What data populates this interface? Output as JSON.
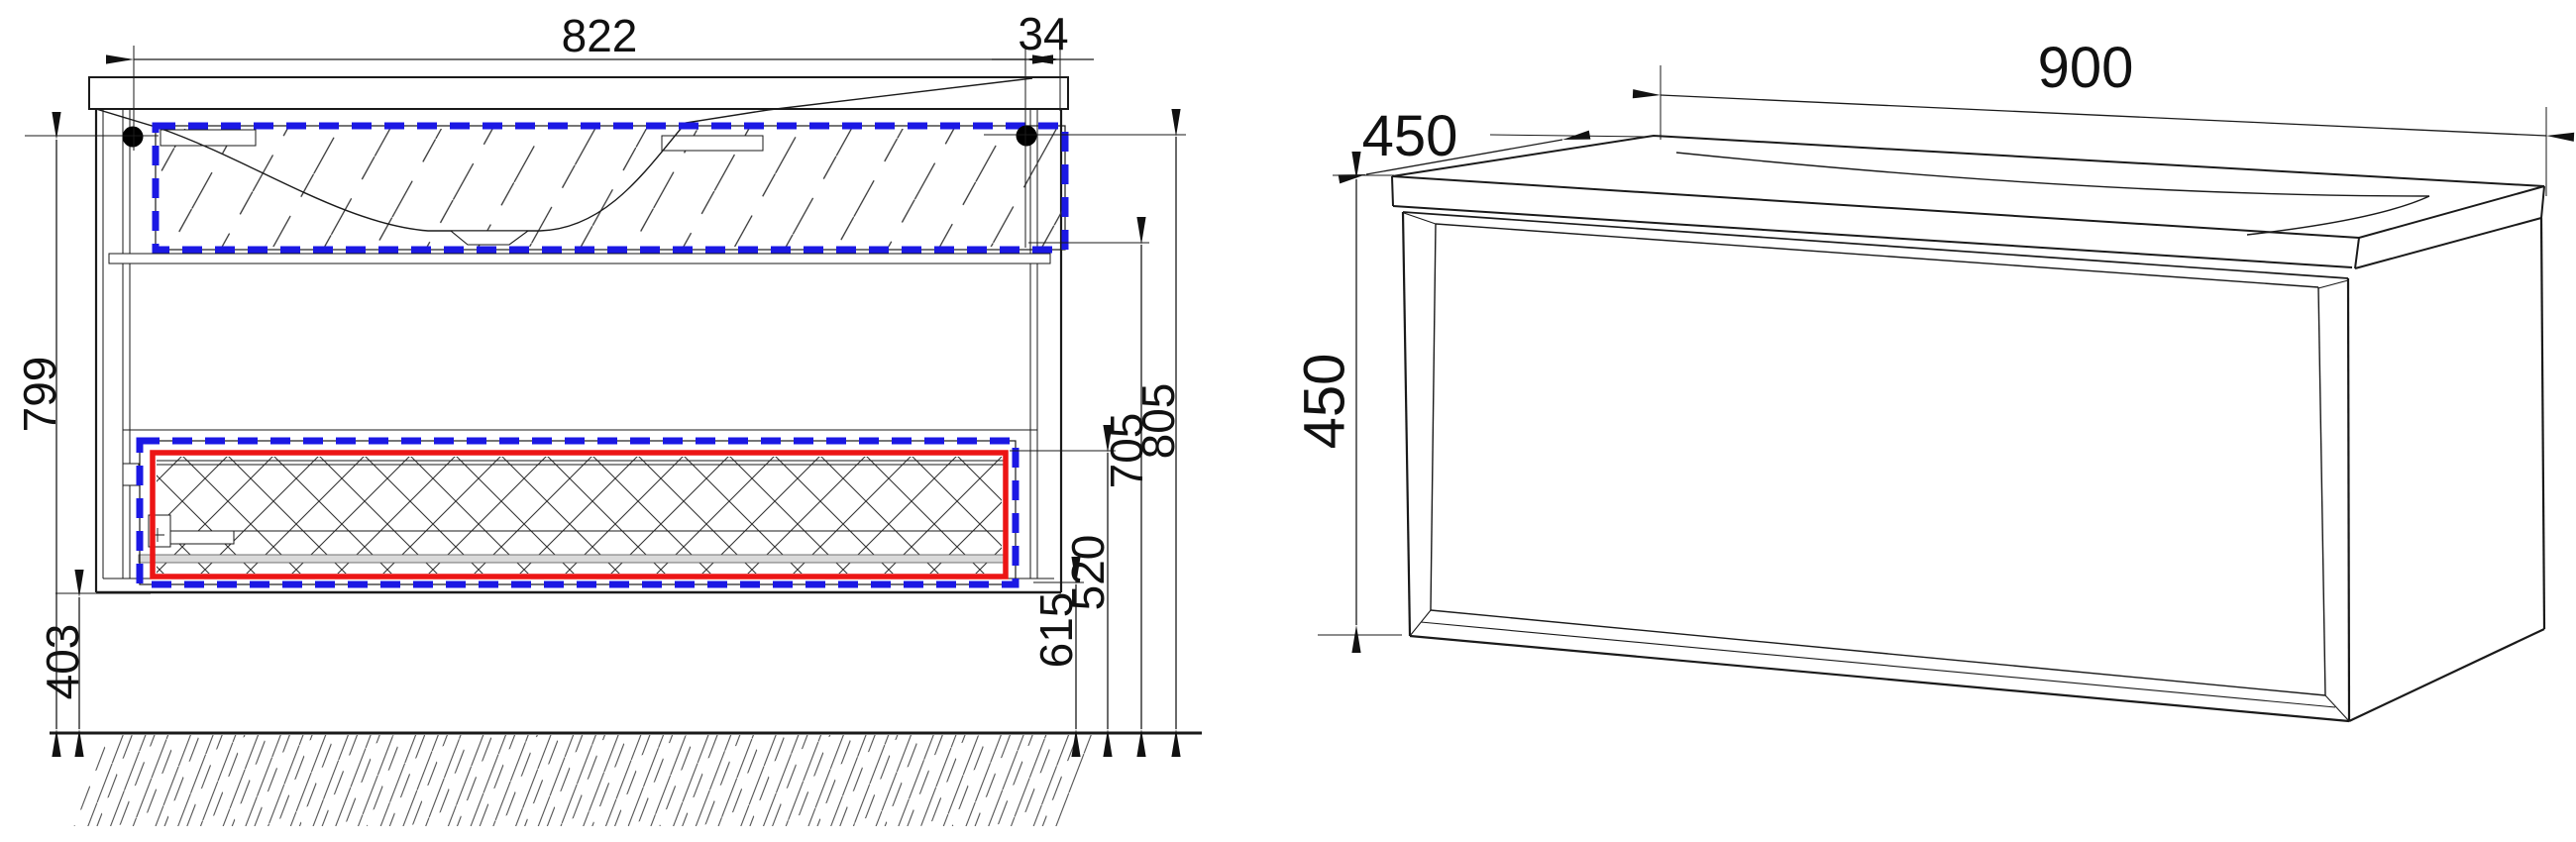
{
  "document": {
    "type": "technical-drawing",
    "description": "Wall-hung vanity cabinet with integrated basin: front section view (left) and 3D perspective view (right)",
    "background": "#ffffff"
  },
  "front_view": {
    "dimensions": {
      "width_822": "822",
      "offset_34": "34",
      "height_799": "799",
      "clearance_403": "403",
      "level_615": "615",
      "level_520": "520",
      "level_705": "705",
      "level_805": "805"
    }
  },
  "perspective_view": {
    "dimensions": {
      "width_900": "900",
      "depth_450": "450",
      "height_450": "450"
    }
  },
  "colors": {
    "sink_highlight": "#1b18e4",
    "drawer_highlight": "#ec1515",
    "line_color": "#1a1a1a"
  }
}
